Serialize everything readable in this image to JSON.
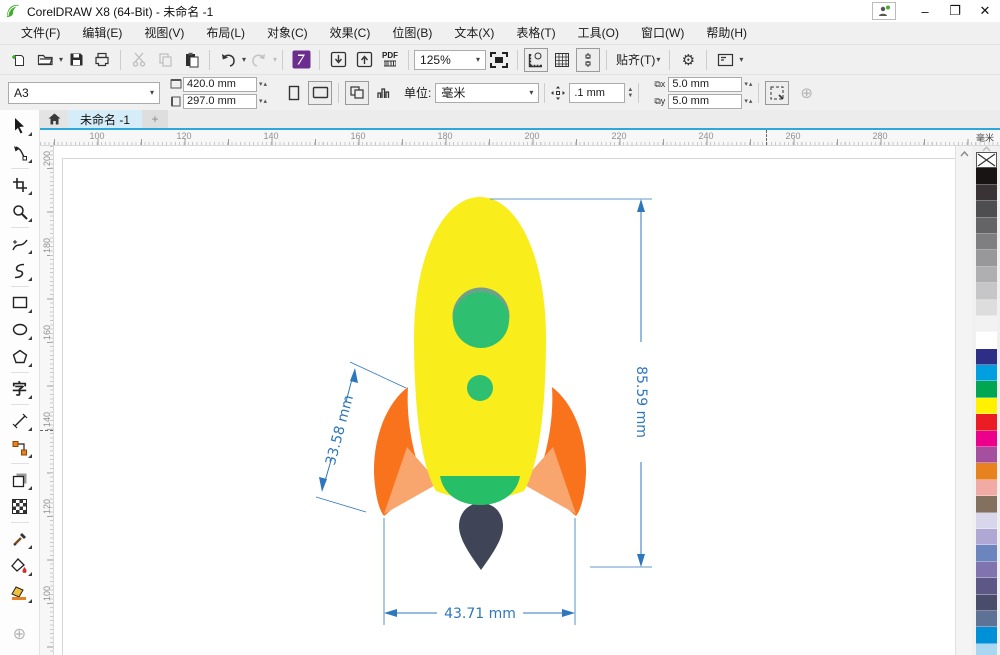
{
  "window": {
    "title": "CorelDRAW X8 (64-Bit) - 未命名 -1",
    "minimize": "–",
    "maximize": "❐",
    "close": "✕"
  },
  "menus": [
    "文件(F)",
    "编辑(E)",
    "视图(V)",
    "布局(L)",
    "对象(C)",
    "效果(C)",
    "位图(B)",
    "文本(X)",
    "表格(T)",
    "工具(O)",
    "窗口(W)",
    "帮助(H)"
  ],
  "toolbar": {
    "zoom_level": "125%",
    "snap_label": "贴齐(T)",
    "pdf_label": "PDF",
    "icons": [
      "new-document",
      "open",
      "save",
      "print",
      "cut",
      "copy",
      "paste",
      "undo",
      "redo",
      "app-launcher",
      "import",
      "export",
      "publish-pdf",
      "zoom-levels",
      "full-screen-preview",
      "show-rulers",
      "show-grid",
      "show-guidelines",
      "snap-to",
      "options",
      "application-panel"
    ]
  },
  "propbar": {
    "page_preset": "A3",
    "page_width": "420.0 mm",
    "page_height": "297.0 mm",
    "units_label": "单位:",
    "units_value": "毫米",
    "nudge_offset": ".1 mm",
    "duplicate_x": "5.0 mm",
    "duplicate_y": "5.0 mm"
  },
  "tabs": {
    "document": "未命名 -1",
    "new_tab": "+"
  },
  "rulers": {
    "h_ticks": [
      "100",
      "120",
      "140",
      "160",
      "180",
      "200",
      "220",
      "240",
      "260",
      "280"
    ],
    "h_unit": "毫米",
    "v_ticks": [
      "200",
      "180",
      "160",
      "140",
      "120",
      "100"
    ]
  },
  "toolbox": {
    "tools": [
      "pick",
      "shape",
      "crop",
      "zoom",
      "freehand",
      "b-spline",
      "rectangle",
      "ellipse",
      "polygon",
      "text",
      "parallel-dimension",
      "connector",
      "drop-shadow",
      "transparency",
      "color-eyedropper",
      "interactive-fill",
      "smart-fill"
    ],
    "text_tool_glyph": "字"
  },
  "canvas": {
    "dimensions": {
      "height_label": "85.59 mm",
      "fin_label": "33.58 mm",
      "width_label": "43.71 mm",
      "color": "#2e77bd"
    },
    "colors": {
      "body": "#f9ed1c",
      "window": "#2fbf71",
      "window_ring": "#6fa08c",
      "cap": "#27be68",
      "fin": "#f9731d",
      "fin_light": "#f9a66e",
      "flame": "#3f4557"
    }
  },
  "palette": {
    "no_color": "X",
    "colors": [
      "#191414",
      "#3a3335",
      "#4e4e50",
      "#646466",
      "#7f7f82",
      "#98989b",
      "#afafb2",
      "#c6c6c9",
      "#ddddde",
      "#f2f2f2",
      "#ffffff",
      "#2d2f86",
      "#009fe0",
      "#00a651",
      "#fff100",
      "#ec1c24",
      "#ec008c",
      "#a4509f",
      "#e8821e",
      "#f2aba4",
      "#83705f",
      "#d7d6ea",
      "#afa8d4",
      "#6c85be",
      "#7f73b0",
      "#5c5784",
      "#494c6b",
      "#5e7295",
      "#0090d8",
      "#a9d7f2"
    ]
  }
}
